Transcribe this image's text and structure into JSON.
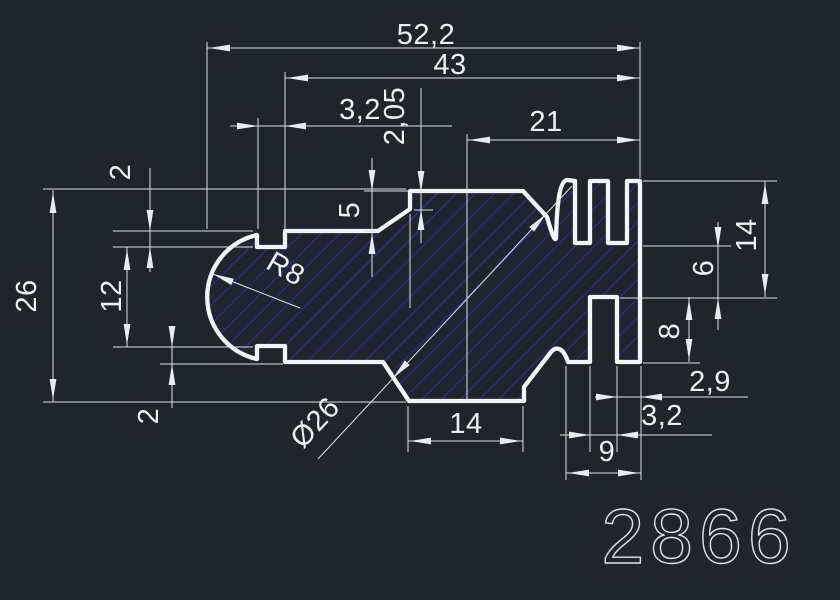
{
  "drawing_number": "2866",
  "colors": {
    "background": "#20242c",
    "profile_line": "#f2f4f6",
    "dimension_line": "#dde1e6",
    "hatch": "#2a2caa",
    "text": "#edf0f3"
  },
  "dimensions": {
    "overall_width": "52,2",
    "upper_width": "43",
    "top_notch_width": "3,2",
    "top_step_height": "2,05",
    "right_top_offset": "21",
    "top_notch_depth": "2",
    "shoulder_drop": "5",
    "overall_height": "26",
    "between_notches": "12",
    "bottom_notch_depth": "2",
    "left_end_radius": "R8",
    "core_diameter": "Ø26",
    "bottom_flat_width": "14",
    "comb_total_width": "9",
    "right_finger_width": "2,9",
    "bottom_slot_width": "3,2",
    "comb_height": "14",
    "web_between_slots": "6",
    "bottom_slot_depth": "8"
  }
}
